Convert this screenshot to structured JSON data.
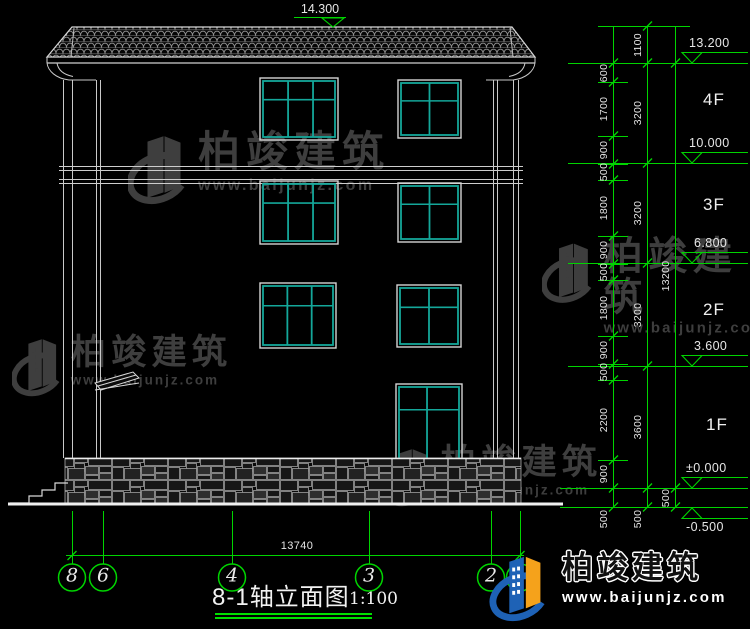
{
  "title": {
    "text": "8-1轴立面图",
    "scale": "1:100"
  },
  "ridge_elevation": "14.300",
  "overall_width_dim": "13740",
  "axis_bubbles": [
    "8",
    "6",
    "4",
    "3",
    "2",
    "1"
  ],
  "floor_labels": [
    "4F",
    "3F",
    "2F",
    "1F"
  ],
  "elevation_markers": [
    "13.200",
    "10.000",
    "6.800",
    "3.600",
    "±0.000",
    "-0.500"
  ],
  "dim_chains": {
    "inner": [
      "600",
      "1700",
      "900",
      "500",
      "1800",
      "900",
      "500",
      "1800",
      "900",
      "500",
      "2200",
      "900",
      "500"
    ],
    "floor_heights": [
      "1100",
      "3200",
      "3200",
      "3200",
      "3600",
      "500"
    ],
    "total": [
      "13200",
      "500"
    ]
  },
  "watermark": {
    "brand": "柏竣建筑",
    "url": "www.baijunjz.com"
  },
  "logo": {
    "brand": "柏竣建筑",
    "url": "www.baijunjz.com"
  },
  "colors": {
    "background": "#000000",
    "lines": "#d4d4d4",
    "bright_line": "#f0f0f0",
    "dims_green": "#00d400",
    "window_teal": "#14a79a",
    "watermark_gray": "#3e3e3e",
    "logo_blue": "#1e62b6",
    "logo_orange": "#f5a21b"
  }
}
